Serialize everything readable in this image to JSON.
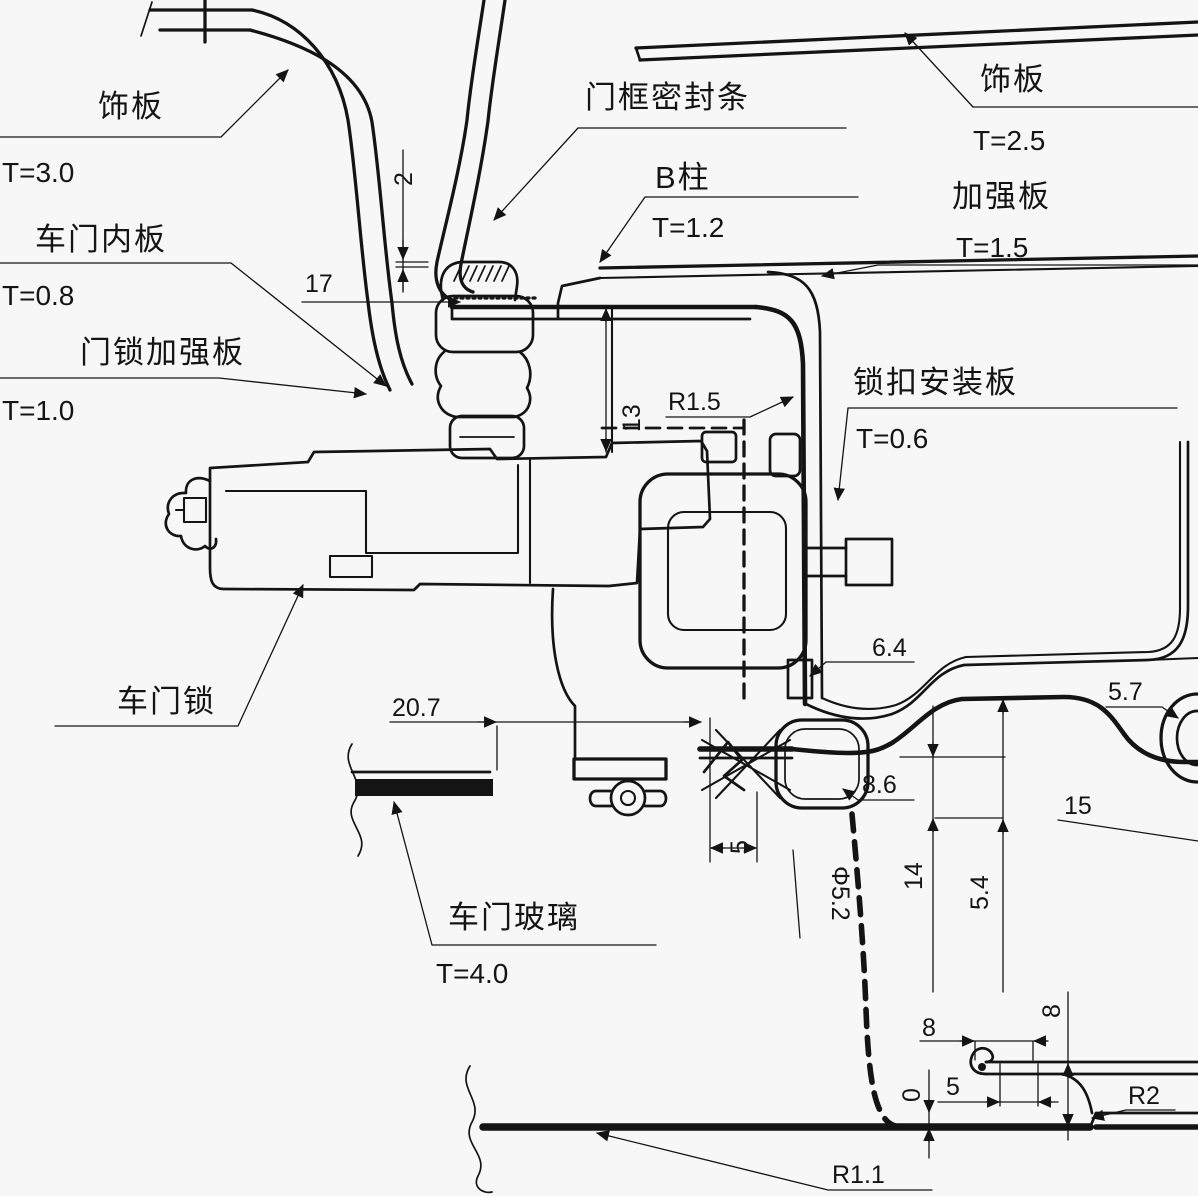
{
  "drawing": {
    "type": "automotive-door-lock-section",
    "background": "#f7f7f7",
    "line_color": "#141414"
  },
  "callouts": [
    {
      "id": "trim-left",
      "label": "饰板",
      "value": "T=3.0"
    },
    {
      "id": "trim-right",
      "label": "饰板",
      "value": "T=2.5"
    },
    {
      "id": "door-frame-seal",
      "label": "门框密封条",
      "value": ""
    },
    {
      "id": "b-pillar",
      "label": "B柱",
      "value": "T=1.2"
    },
    {
      "id": "reinforcement",
      "label": "加强板",
      "value": "T=1.5"
    },
    {
      "id": "door-inner-panel",
      "label": "车门内板",
      "value": "T=0.8"
    },
    {
      "id": "lock-reinforcement",
      "label": "门锁加强板",
      "value": "T=1.0"
    },
    {
      "id": "striker-mount-plate",
      "label": "锁扣安装板",
      "value": "T=0.6"
    },
    {
      "id": "door-lock",
      "label": "车门锁",
      "value": ""
    },
    {
      "id": "door-glass",
      "label": "车门玻璃",
      "value": "T=4.0"
    }
  ],
  "dims": {
    "gap2": "2",
    "d17": "17",
    "d13": "13",
    "r15": "R1.5",
    "d207": "20.7",
    "d64": "6.4",
    "d57": "5.7",
    "d15": "15",
    "d86": "8.6",
    "d14": "14",
    "d54": "5.4",
    "dphi": "Φ5.2",
    "d5s": "5",
    "d8h": "8",
    "d8v": "8",
    "d5b": "5",
    "d0": "0",
    "r2": "R2",
    "r11": "R1.1"
  }
}
